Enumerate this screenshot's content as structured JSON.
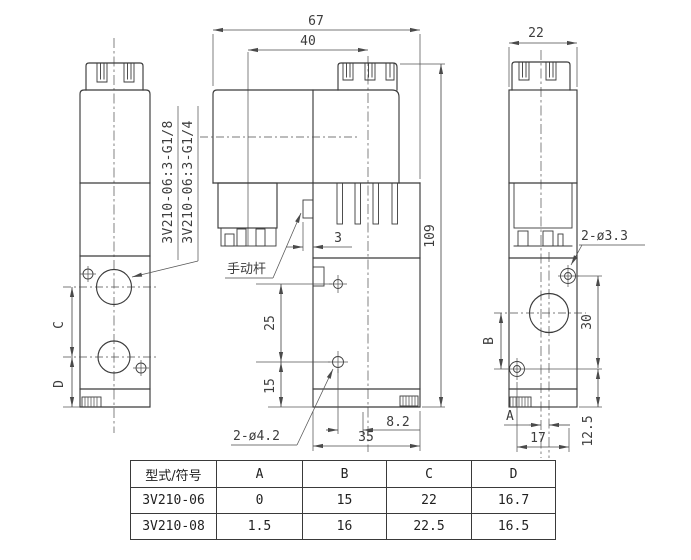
{
  "views": {
    "left": {
      "dims": {
        "c": "C",
        "d": "D"
      },
      "labels": {
        "model_line1": "3V210-06:3-G1/8",
        "model_line2": "3V210-06:3-G1/4"
      }
    },
    "front": {
      "dims": {
        "overall_width": "67",
        "coil_offset": "40",
        "overall_height": "109",
        "lever_offset": "3",
        "hole_spacing": "25",
        "hole_to_bottom": "15",
        "hole_offset": "8.2",
        "body_width": "35"
      },
      "labels": {
        "mount_holes": "2-ø4.2",
        "manual_lever": "手动杆"
      }
    },
    "side": {
      "dims": {
        "body_depth": "22",
        "hole_height": "30",
        "b": "B",
        "a": "A",
        "hole_span": "17",
        "bottom_height": "12.5"
      },
      "labels": {
        "mount_holes": "2-ø3.3"
      }
    }
  },
  "table": {
    "headers": [
      "型式/符号",
      "A",
      "B",
      "C",
      "D"
    ],
    "rows": [
      [
        "3V210-06",
        "0",
        "15",
        "22",
        "16.7"
      ],
      [
        "3V210-08",
        "1.5",
        "16",
        "22.5",
        "16.5"
      ]
    ]
  }
}
